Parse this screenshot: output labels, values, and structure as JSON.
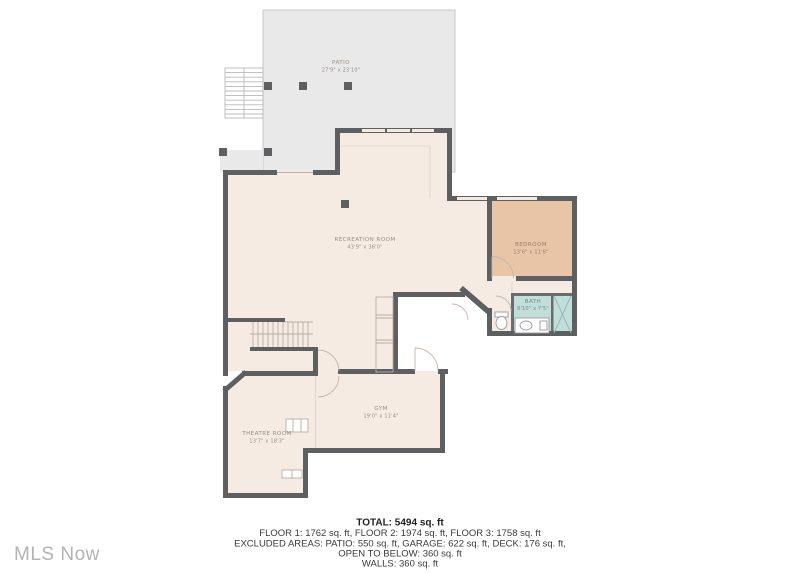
{
  "floor_plan": {
    "rooms": {
      "patio": {
        "name": "PATIO",
        "dims": "27'9\" x 23'10\""
      },
      "recreation_room": {
        "name": "RECREATION ROOM",
        "dims": "43'9\" x 36'0\""
      },
      "bedroom": {
        "name": "BEDROOM",
        "dims": "13'6\" x 11'6\""
      },
      "bath": {
        "name": "BATH",
        "dims": "8'10\" x 7'5\""
      },
      "theatre_room": {
        "name": "THEATRE ROOM",
        "dims": "13'7\" x 18'3\""
      },
      "gym": {
        "name": "GYM",
        "dims": "19'0\" x 11'4\""
      }
    },
    "summary": {
      "total": "TOTAL: 5494 sq. ft",
      "floors": "FLOOR 1: 1762 sq. ft, FLOOR 2: 1974 sq. ft, FLOOR 3: 1758 sq. ft",
      "excluded": "EXCLUDED AREAS: PATIO: 550 sq. ft, GARAGE: 622 sq. ft, DECK: 176 sq. ft,",
      "open_below": "OPEN TO BELOW: 360 sq. ft",
      "walls": "WALLS: 360 sq. ft"
    },
    "watermark": "MLS Now",
    "colors": {
      "wall": "#5e5f61",
      "floor": "#f6ebe3",
      "patio": "#e9e9ea",
      "bedroom": "#e8c5a6",
      "bath": "#c2dedb",
      "label_text": "#9b8c82",
      "summary_text": "#3a3a3c",
      "watermark": "#b3b3b3"
    }
  }
}
